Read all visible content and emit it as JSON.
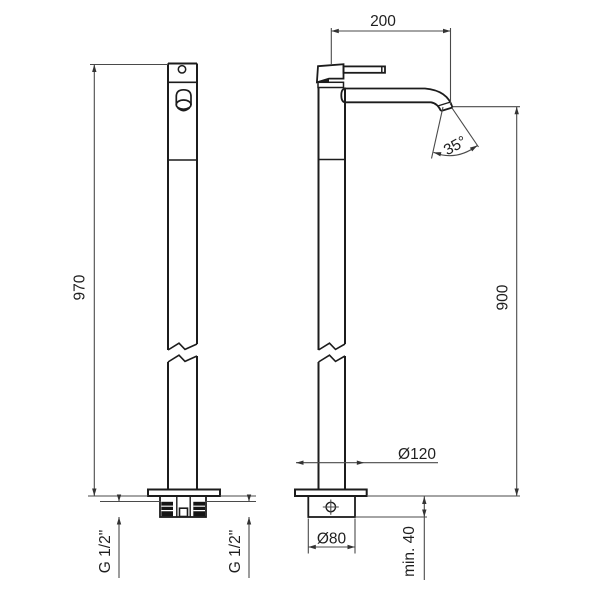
{
  "drawing": {
    "type": "faucet-technical-drawing",
    "views": {
      "left": "side view of freestanding column mixer",
      "right": "front view of freestanding column mixer"
    },
    "dimensions": {
      "spout_reach": "200",
      "spout_angle": "35°",
      "spout_height": "900",
      "total_height": "970",
      "base_plate_diameter": "Ø120",
      "base_body_diameter": "Ø80",
      "min_recess_depth": "min. 40",
      "thread_left": "G 1/2\"",
      "thread_right": "G 1/2\""
    },
    "colors": {
      "object_line": "#1c1c1c",
      "dimension_line": "#4a4a4a",
      "text": "#1f1f1f",
      "background": "#ffffff"
    }
  }
}
